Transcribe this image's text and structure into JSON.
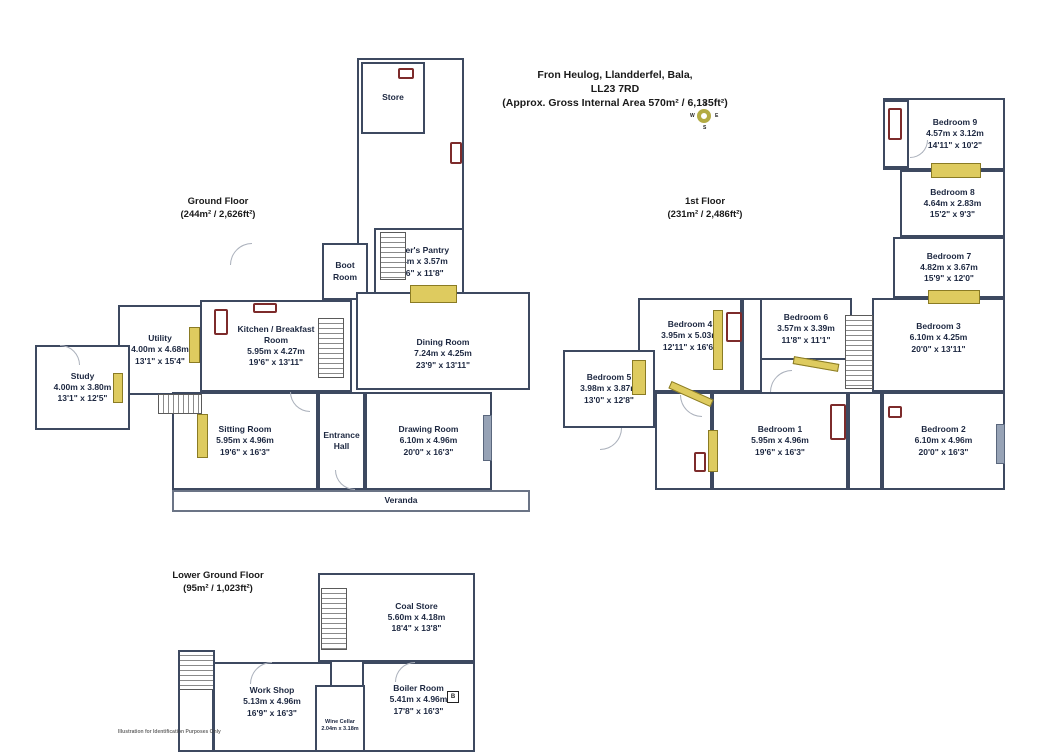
{
  "title": {
    "line1": "Fron Heulog, Llandderfel, Bala,",
    "line2": "LL23 7RD",
    "line3": "(Approx. Gross Internal Area 570m² / 6,135ft²)"
  },
  "compass": {
    "n": "N",
    "e": "E",
    "s": "S",
    "w": "W"
  },
  "floors": {
    "ground": {
      "label": "Ground Floor",
      "area": "(244m² / 2,626ft²)",
      "rooms": {
        "store": {
          "name": "Store"
        },
        "boot": {
          "name": "Boot Room"
        },
        "pantry": {
          "name": "Butler's Pantry",
          "metric": "4.74m x 3.57m",
          "imperial": "15'6\" x 11'8\""
        },
        "dining": {
          "name": "Dining Room",
          "metric": "7.24m x 4.25m",
          "imperial": "23'9\" x 13'11\""
        },
        "kitchen": {
          "name": "Kitchen / Breakfast Room",
          "metric": "5.95m x 4.27m",
          "imperial": "19'6\" x 13'11\""
        },
        "utility": {
          "name": "Utility",
          "metric": "4.00m x 4.68m",
          "imperial": "13'1\" x 15'4\""
        },
        "study": {
          "name": "Study",
          "metric": "4.00m x 3.80m",
          "imperial": "13'1\" x 12'5\""
        },
        "sitting": {
          "name": "Sitting Room",
          "metric": "5.95m x 4.96m",
          "imperial": "19'6\" x 16'3\""
        },
        "hall": {
          "name": "Entrance Hall"
        },
        "drawing": {
          "name": "Drawing Room",
          "metric": "6.10m x 4.96m",
          "imperial": "20'0\" x 16'3\""
        },
        "veranda": {
          "name": "Veranda"
        }
      }
    },
    "first": {
      "label": "1st Floor",
      "area": "(231m² / 2,486ft²)",
      "rooms": {
        "bed9": {
          "name": "Bedroom 9",
          "metric": "4.57m x 3.12m",
          "imperial": "14'11\" x 10'2\""
        },
        "bed8": {
          "name": "Bedroom 8",
          "metric": "4.64m x 2.83m",
          "imperial": "15'2\" x 9'3\""
        },
        "bed7": {
          "name": "Bedroom 7",
          "metric": "4.82m x 3.67m",
          "imperial": "15'9\" x 12'0\""
        },
        "bed4": {
          "name": "Bedroom 4",
          "metric": "3.95m x 5.03m",
          "imperial": "12'11\" x 16'6\""
        },
        "bed5": {
          "name": "Bedroom 5",
          "metric": "3.98m x 3.87m",
          "imperial": "13'0\" x 12'8\""
        },
        "bed6": {
          "name": "Bedroom 6",
          "metric": "3.57m x 3.39m",
          "imperial": "11'8\" x 11'1\""
        },
        "bed3": {
          "name": "Bedroom 3",
          "metric": "6.10m x 4.25m",
          "imperial": "20'0\" x 13'11\""
        },
        "bed1": {
          "name": "Bedroom 1",
          "metric": "5.95m x 4.96m",
          "imperial": "19'6\" x 16'3\""
        },
        "bed2": {
          "name": "Bedroom 2",
          "metric": "6.10m x 4.96m",
          "imperial": "20'0\" x 16'3\""
        }
      }
    },
    "lower": {
      "label": "Lower Ground Floor",
      "area": "(95m² / 1,023ft²)",
      "rooms": {
        "coal": {
          "name": "Coal Store",
          "metric": "5.60m x 4.18m",
          "imperial": "18'4\" x 13'8\""
        },
        "boiler": {
          "name": "Boiler Room",
          "metric": "5.41m x 4.96m",
          "imperial": "17'8\" x 16'3\""
        },
        "workshop": {
          "name": "Work Shop",
          "metric": "5.13m x 4.96m",
          "imperial": "16'9\" x 16'3\""
        },
        "wine": {
          "name": "Wine Cellar",
          "metric": "2.04m x 3.18m"
        }
      }
    }
  },
  "markers": {
    "boiler": "B"
  },
  "footer": "Illustration for Identification Purposes Only",
  "colors": {
    "wall": "#3d4960",
    "window": "#decb5f",
    "fixture": "#7d2b2b",
    "glazing": "#97a3b6"
  }
}
